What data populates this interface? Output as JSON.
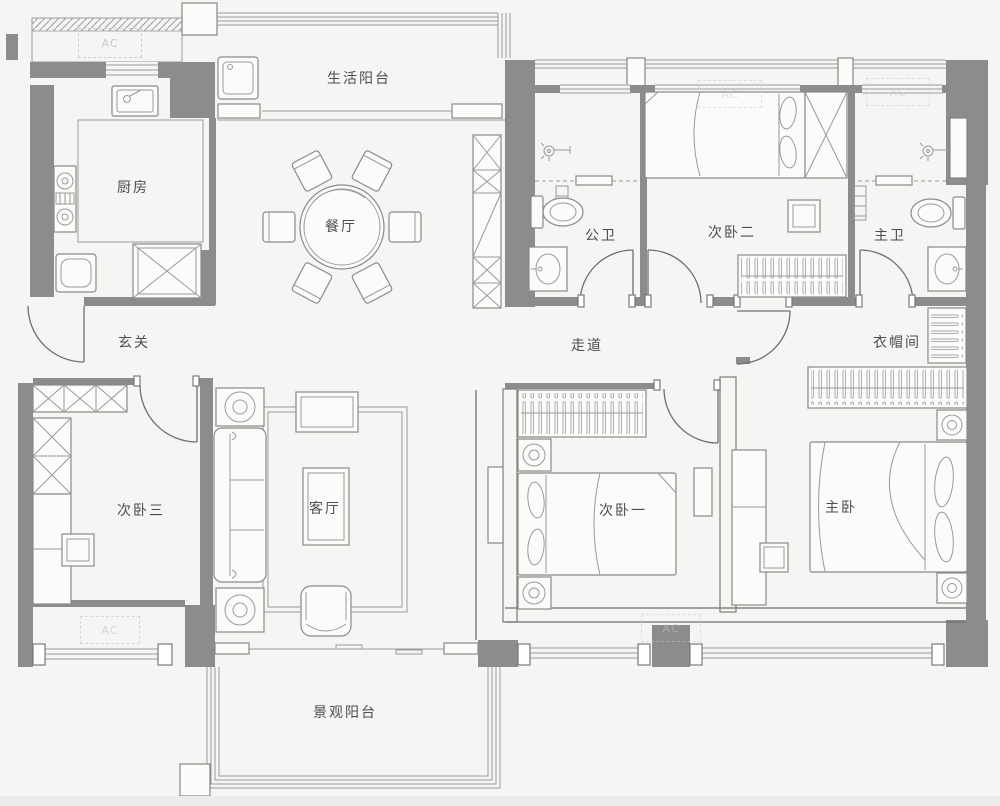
{
  "colors": {
    "background": "#f5f5f3",
    "wall": "#8c8c8c",
    "line": "#6f6f6d",
    "furniture_line": "#9a9a98",
    "label_text": "#4d4d4d",
    "ac_text": "#c6c6c4"
  },
  "ac": {
    "label": "AC"
  },
  "rooms": [
    {
      "id": "life-balcony",
      "label": "生活阳台"
    },
    {
      "id": "kitchen",
      "label": "厨房"
    },
    {
      "id": "dining-room",
      "label": "餐厅"
    },
    {
      "id": "public-bathroom",
      "label": "公卫"
    },
    {
      "id": "bedroom-2",
      "label": "次卧二"
    },
    {
      "id": "master-bathroom",
      "label": "主卫"
    },
    {
      "id": "entry",
      "label": "玄关"
    },
    {
      "id": "corridor",
      "label": "走道"
    },
    {
      "id": "cloakroom",
      "label": "衣帽间"
    },
    {
      "id": "bedroom-3",
      "label": "次卧三"
    },
    {
      "id": "living-room",
      "label": "客厅"
    },
    {
      "id": "bedroom-1",
      "label": "次卧一"
    },
    {
      "id": "master-bedroom",
      "label": "主卧"
    },
    {
      "id": "view-balcony",
      "label": "景观阳台"
    }
  ]
}
